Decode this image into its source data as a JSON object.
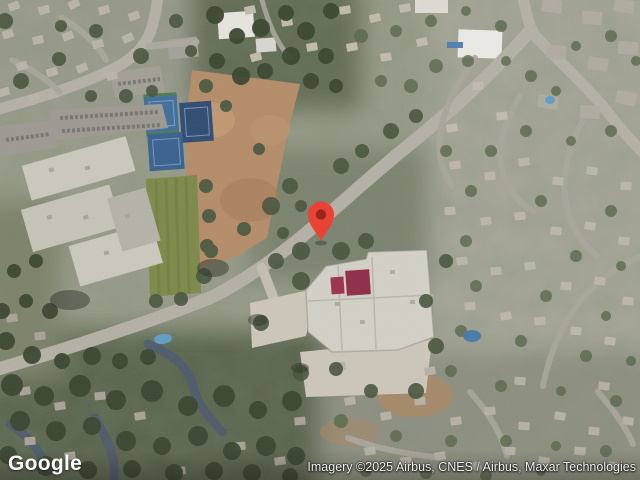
{
  "map": {
    "view_type": "satellite",
    "logo_text": "Google",
    "attribution_text": "Imagery ©2025 Airbus, CNES / Airbus, Maxar Technologies",
    "marker": {
      "color": "#E94335",
      "dot_color": "#99271E",
      "pixel_x": 321,
      "pixel_y": 241
    },
    "colors": {
      "road": "#b5b0a5",
      "street": "#a9a69b",
      "shaded_lane": "#4b5870",
      "dirt_field": "#b48c67",
      "sports_field": "#7c8948",
      "tennis_blue": "#3e6e9b",
      "tennis_navy": "#2e4a72",
      "school_roof": "#cbc8bd",
      "event_roof": "#d3d1c7",
      "maroon_roof": "#9b2f4e",
      "tree_canopy": "#39452f",
      "pool_blue": "#5f9ec4"
    }
  }
}
